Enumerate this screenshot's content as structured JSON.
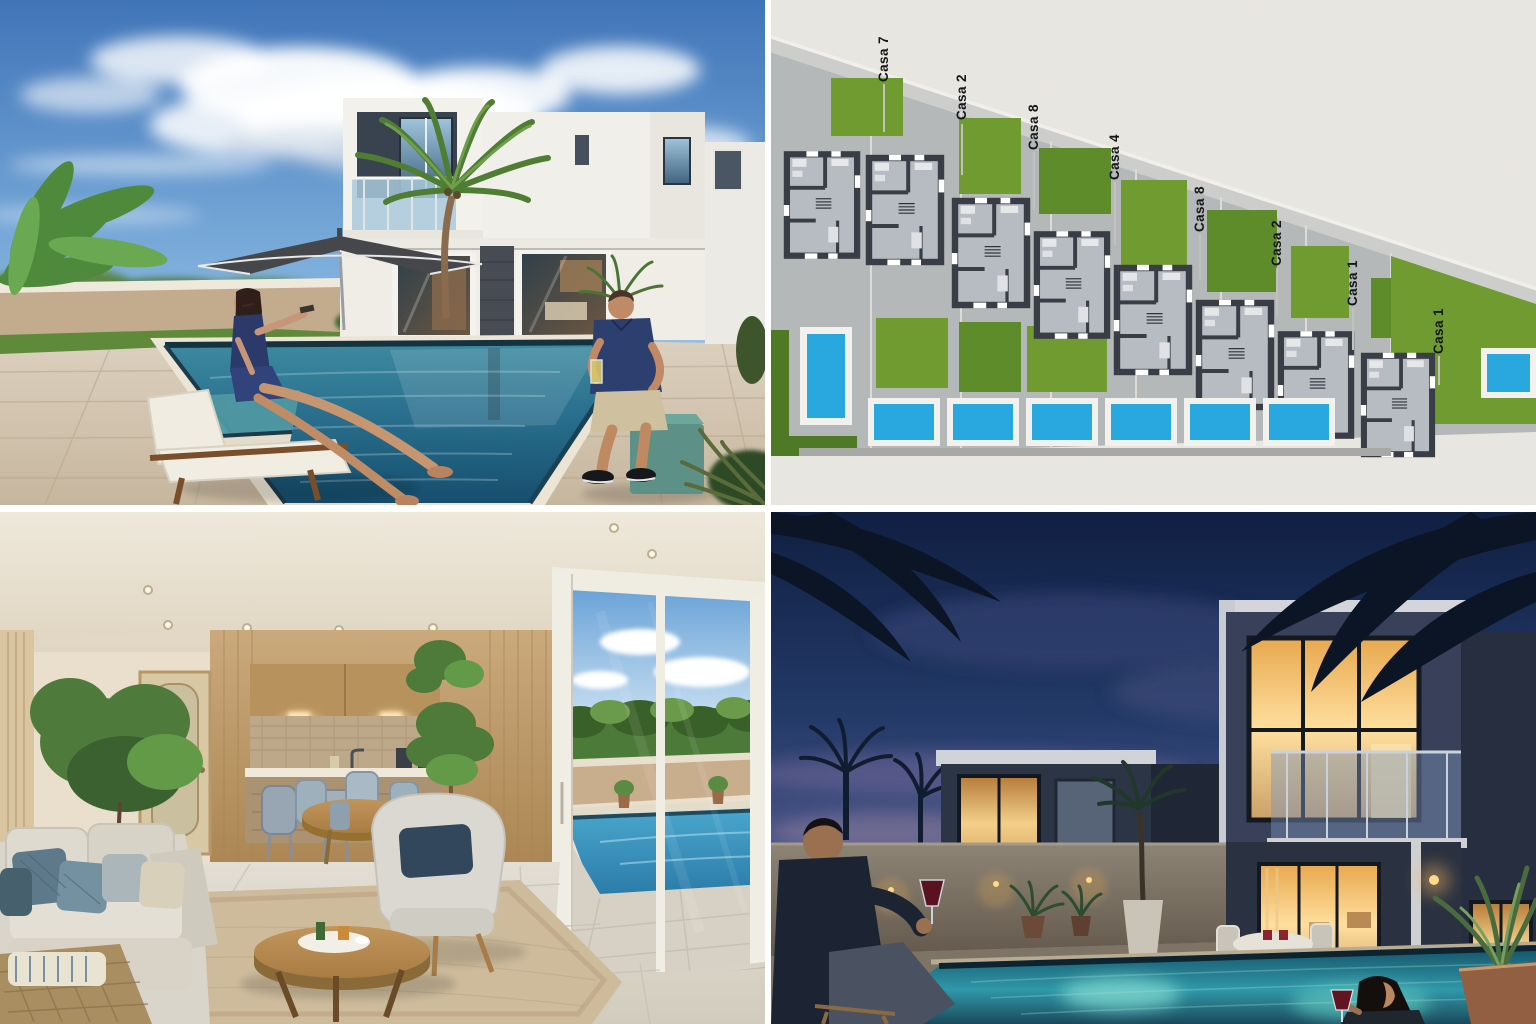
{
  "page": {
    "title": "Residential development collage — casas com piscina",
    "layout": "2x2 photo grid",
    "background": "#ffffff"
  },
  "panels": {
    "exterior_day": {
      "position": "top-left",
      "alt": "Daytime rendering: white two-storey modern house, palm trees, patio umbrella, swimming pool, woman on a lounger and man seated on a teal cube stool"
    },
    "site_plan": {
      "position": "top-right",
      "alt": "Top-view site plan of eight staggered row houses with lawns and blue pools",
      "labels": [
        "Casa 7",
        "Casa 2",
        "Casa 8",
        "Casa 4",
        "Casa 8",
        "Casa 2",
        "Casa 1",
        "Casa 1"
      ]
    },
    "interior": {
      "position": "bottom-left",
      "alt": "Interior rendering: living room with sofa, armchair, round coffee table, kitchenette with bar stools, and sliding glass doors opening to a pool"
    },
    "exterior_night": {
      "position": "bottom-right",
      "alt": "Night rendering: dark modern villas with warm lit windows, glowing pool, man with wine glass on deck and woman in the pool"
    }
  },
  "colors": {
    "pool_blue": "#29a8df",
    "lawn_green": "#6f9b31",
    "plan_wall": "#3a3f48",
    "paper": "#eae8e2",
    "sky_day_top": "#3f74b8",
    "sky_night_top": "#101f42",
    "stool_teal": "#5d9187",
    "window_glow": "#f2cf8a"
  }
}
